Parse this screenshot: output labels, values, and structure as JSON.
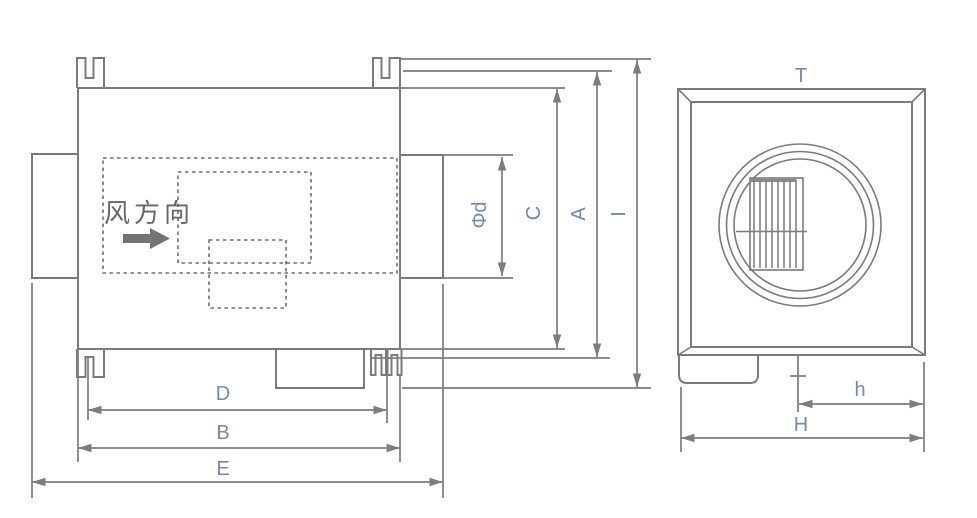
{
  "side_view": {
    "airflow_label": "风方向",
    "dim_phi_d": "Φd",
    "dim_c": "C",
    "dim_a": "A",
    "dim_i": "I",
    "dim_d": "D",
    "dim_b": "B",
    "dim_e": "E"
  },
  "front_view": {
    "label_t": "T",
    "dim_h": "h",
    "dim_cap_h": "H"
  },
  "colors": {
    "line": "#7b7b7b",
    "dimension": "#7d7d7d",
    "label": "#7589a8",
    "cjk_text": "#676767",
    "background": "#ffffff"
  }
}
